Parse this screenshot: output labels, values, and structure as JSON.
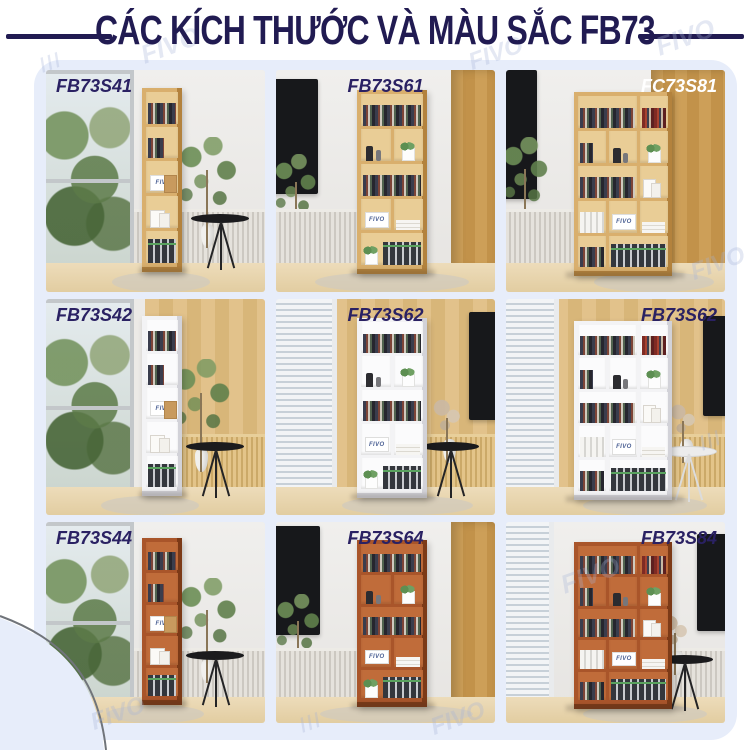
{
  "title": "CÁC KÍCH THƯỚC VÀ MÀU SẮC FB73",
  "brand_watermark": "FIVO",
  "hatch": "///",
  "shelf_logo": "FIVO",
  "colors": {
    "accent_navy": "#211b52",
    "panel_blue": "#e7edfa",
    "label_navy": "#2a2163",
    "label_white": "#ffffff",
    "finish_oak": "#d9af6d",
    "finish_white": "#f3f3f5",
    "finish_cherry": "#a9552a"
  },
  "grid": {
    "cells": [
      {
        "label": "FB73S41",
        "finish": "oak",
        "size": "narrow-5-shelf",
        "label_position": "top-left",
        "label_color": "#2a2163"
      },
      {
        "label": "FB73S61",
        "finish": "oak",
        "size": "medium-2-column",
        "label_position": "top-center",
        "label_color": "#2a2163"
      },
      {
        "label": "FC73S81",
        "finish": "oak",
        "size": "wide-3-column",
        "label_position": "top-right",
        "label_color": "#ffffff"
      },
      {
        "label": "FB73S42",
        "finish": "white",
        "size": "narrow-5-shelf",
        "label_position": "top-left",
        "label_color": "#2a2163"
      },
      {
        "label": "FB73S62",
        "finish": "white",
        "size": "medium-2-column",
        "label_position": "top-center",
        "label_color": "#2a2163"
      },
      {
        "label": "FB73S62",
        "finish": "white",
        "size": "wide-3-column",
        "label_position": "top-right",
        "label_color": "#2a2163"
      },
      {
        "label": "FB73S44",
        "finish": "cherry",
        "size": "narrow-5-shelf",
        "label_position": "top-left",
        "label_color": "#2a2163"
      },
      {
        "label": "FB73S64",
        "finish": "cherry",
        "size": "medium-2-column",
        "label_position": "top-center",
        "label_color": "#2a2163"
      },
      {
        "label": "FB73S84",
        "finish": "cherry",
        "size": "wide-3-column",
        "label_position": "top-right",
        "label_color": "#2a2163"
      }
    ]
  }
}
